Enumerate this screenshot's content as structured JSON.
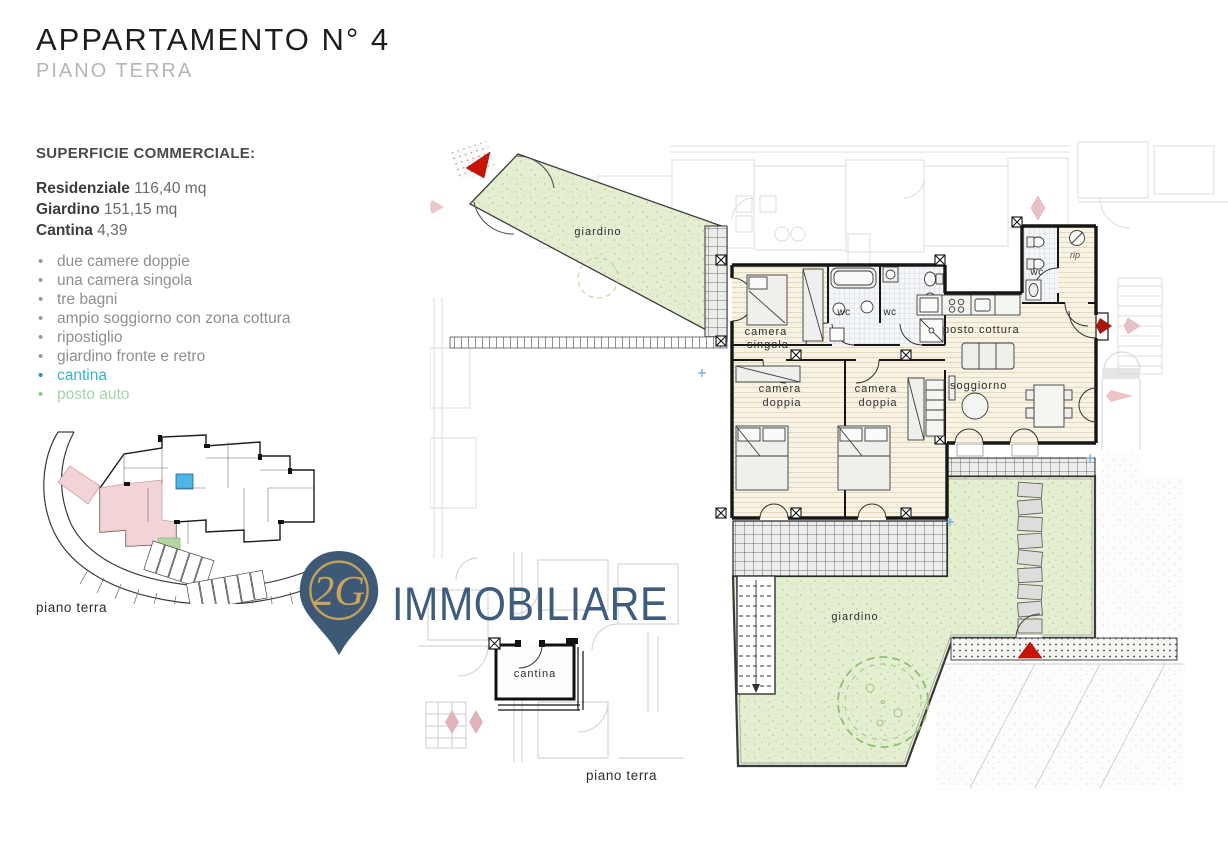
{
  "header": {
    "title": "APPARTAMENTO N° 4",
    "subtitle": "PIANO TERRA"
  },
  "surface": {
    "heading": "SUPERFICIE COMMERCIALE:",
    "rows": [
      {
        "label": "Residenziale",
        "value": "116,40 mq"
      },
      {
        "label": "Giardino",
        "value": "151,15 mq"
      },
      {
        "label": "Cantina",
        "value": "4,39"
      }
    ]
  },
  "features": {
    "items": [
      {
        "text": "due camere doppie",
        "color": "#8f8f8f"
      },
      {
        "text": "una camera singola",
        "color": "#8f8f8f"
      },
      {
        "text": "tre bagni",
        "color": "#8f8f8f"
      },
      {
        "text": "ampio soggiorno con zona cottura",
        "color": "#8f8f8f"
      },
      {
        "text": "ripostiglio",
        "color": "#8f8f8f"
      },
      {
        "text": "giardino fronte e retro",
        "color": "#8f8f8f"
      },
      {
        "text": "cantina",
        "color": "#35b5c9"
      },
      {
        "text": "posto auto",
        "color": "#a7d3a9"
      }
    ]
  },
  "site_plan": {
    "caption": "piano terra"
  },
  "logo": {
    "monogram": "2G",
    "name": "IMMOBILIARE"
  },
  "cantina_plan": {
    "room_label": "cantina",
    "caption": "piano terra"
  },
  "main_plan": {
    "caption": "piano terra",
    "labels": {
      "garden_top": "giardino",
      "garden_bottom": "giardino",
      "single_room_line1": "camera",
      "single_room_line2": "singola",
      "bath1": "wc",
      "bath2": "wc",
      "bath3": "wc",
      "storage": "rip",
      "kitchen": "posto cottura",
      "living": "soggiorno",
      "double_room1_line1": "camera",
      "double_room1_line2": "doppia",
      "double_room2_line1": "camera",
      "double_room2_line2": "doppia"
    }
  },
  "colors": {
    "accent_teal": "#35b5c9",
    "accent_green": "#a7d3a9",
    "logo_slate": "#3f5b7e",
    "logo_gold": "#c6a257",
    "marker_red": "#c81408",
    "garden_green": "#e4efd2",
    "site_highlight_pink": "#f2d3d6",
    "site_highlight_blue": "#4fb6e8",
    "site_parking_green": "#b2d7a2"
  }
}
